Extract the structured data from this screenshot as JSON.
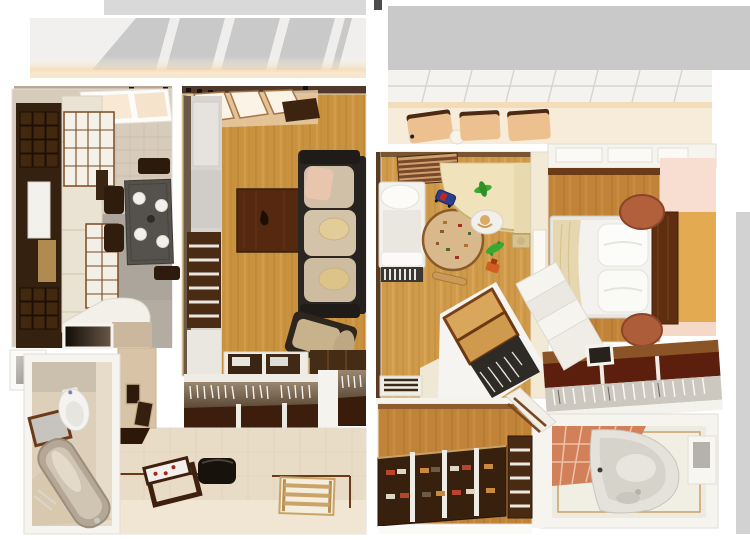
{
  "palette": {
    "white": "#ffffff",
    "offWhite": "#f6f4ef",
    "wallEdge": "#e2ded6",
    "roofGray": "#c9c9c9",
    "roofGrayLight": "#d9d9d9",
    "glowPeach": "#f2d4a8",
    "oakLiving": "#c8923f",
    "oakChild": "#cf9a4a",
    "oakBedroom": "#c08338",
    "kitchenWallTile": "#d7ccbc",
    "kitchenGray": "#aba59b",
    "darkCabinet": "#35210f",
    "creamCabinet": "#eae3d4",
    "tableSlate": "#55524d",
    "walnut": "#54290f",
    "sofaFrame": "#2b2622",
    "sofaBeige": "#d0c0a8",
    "pillowYellow": "#e2cc98",
    "pillowPink": "#e9c5ad",
    "closetDark": "#3d1d0c",
    "hangerWhite": "#f4f2ee",
    "hallTile": "#e9dcc6",
    "baseboardBrown": "#6b3a1a",
    "bathWall": "#ddcfba",
    "tubMetal": "#b5a795",
    "mirrorGlass": "#c7c3bd",
    "porcelain": "#f4f3f0",
    "stripeBrown": "#7a4828",
    "stripeTan": "#caa06e",
    "rugTan": "#d9b98c",
    "rugBorder": "#8a5a28",
    "deskCream": "#f0e2ba",
    "toyGreen": "#3aa832",
    "toyBlue": "#2a3e8f",
    "toyRed": "#c42818",
    "toyOrange": "#d06020",
    "batTan": "#c99a58",
    "bedWhite": "#f3f2ee",
    "blanketBeige": "#e7d7b1",
    "radiatorDark": "#3a3632",
    "pinkWall": "#f8ded0",
    "goldWall": "#e3aa52",
    "stoolBrown": "#b2603c",
    "headboardBrown": "#5f2e10",
    "closetRedPlank": "#5c1e0d",
    "terracotta": "#d2805a",
    "groutPeach": "#ecc3a8",
    "tubWhite": "#e4e2db",
    "bookshelfDark": "#38200e",
    "bookRed": "#b8442a",
    "bookTan": "#c98a40",
    "bookWhite": "#ddd5c6",
    "slatUnit": "#4a2a12",
    "wardrobeTan": "#d9a75c",
    "wardrobeFrame": "#7a4018",
    "wardrobeShadow": "#2e2a26",
    "balconyChair": "#ecc18f",
    "balconyChairEdge": "#4a2a12",
    "balconyFloor": "#f6ecd9",
    "grayStrip": "#d2d2d2",
    "consoleBrown": "#3f200f",
    "bagBlack": "#17120c",
    "matTan": "#c9a368"
  },
  "scene": {
    "kind": "3d-render-floor-plan",
    "view": "top-down cutaway",
    "units": [
      {
        "name": "left-apartment",
        "rooms": [
          {
            "name": "kitchen",
            "furniture": [
              "tall-dark-cabinet",
              "cream-cabinets",
              "paned-cabinet-doors",
              "dining-table",
              "white-plates",
              "dark-chairs",
              "skylight",
              "curved-partition",
              "dark-doorway"
            ]
          },
          {
            "name": "living-room",
            "furniture": [
              "wardrobe-unit",
              "louver-doors",
              "coffee-table",
              "sofa",
              "seat-cushions",
              "bolster-pillows",
              "ottoman",
              "shelf-units",
              "skylight-windows"
            ]
          },
          {
            "name": "bathroom",
            "furniture": [
              "framed-mirror",
              "toilet",
              "bathtub",
              "wall-niche",
              "towel-rack"
            ]
          },
          {
            "name": "hallway",
            "furniture": [
              "coat-closet-hangers",
              "console-table",
              "dark-bag",
              "slatted-mat",
              "picture-frames",
              "tile-floor"
            ]
          }
        ]
      },
      {
        "name": "right-apartment",
        "rooms": [
          {
            "name": "balcony",
            "furniture": [
              "glazed-roof-grid",
              "lounge-chairs",
              "small-table"
            ]
          },
          {
            "name": "childrens-room",
            "furniture": [
              "single-bed",
              "slatted-radiator-footboard",
              "round-play-rug",
              "corner-desk",
              "stool-with-child",
              "toy-car",
              "green-toys",
              "orange-toy",
              "wooden-bat",
              "striped-blind",
              "diagonal-wardrobe-with-hangers"
            ]
          },
          {
            "name": "bedroom",
            "furniture": [
              "double-bed",
              "two-pillows",
              "beige-blanket",
              "headboard-panel",
              "round-stool-top",
              "round-stool-bottom",
              "closet-rail-hangers"
            ]
          },
          {
            "name": "bathroom",
            "furniture": [
              "corner-bathtub",
              "terracotta-tile-wall",
              "wall-niche"
            ]
          },
          {
            "name": "hallway-library",
            "furniture": [
              "bookshelf",
              "books",
              "slatted-cabinet",
              "diagonal-door"
            ]
          }
        ]
      }
    ]
  }
}
